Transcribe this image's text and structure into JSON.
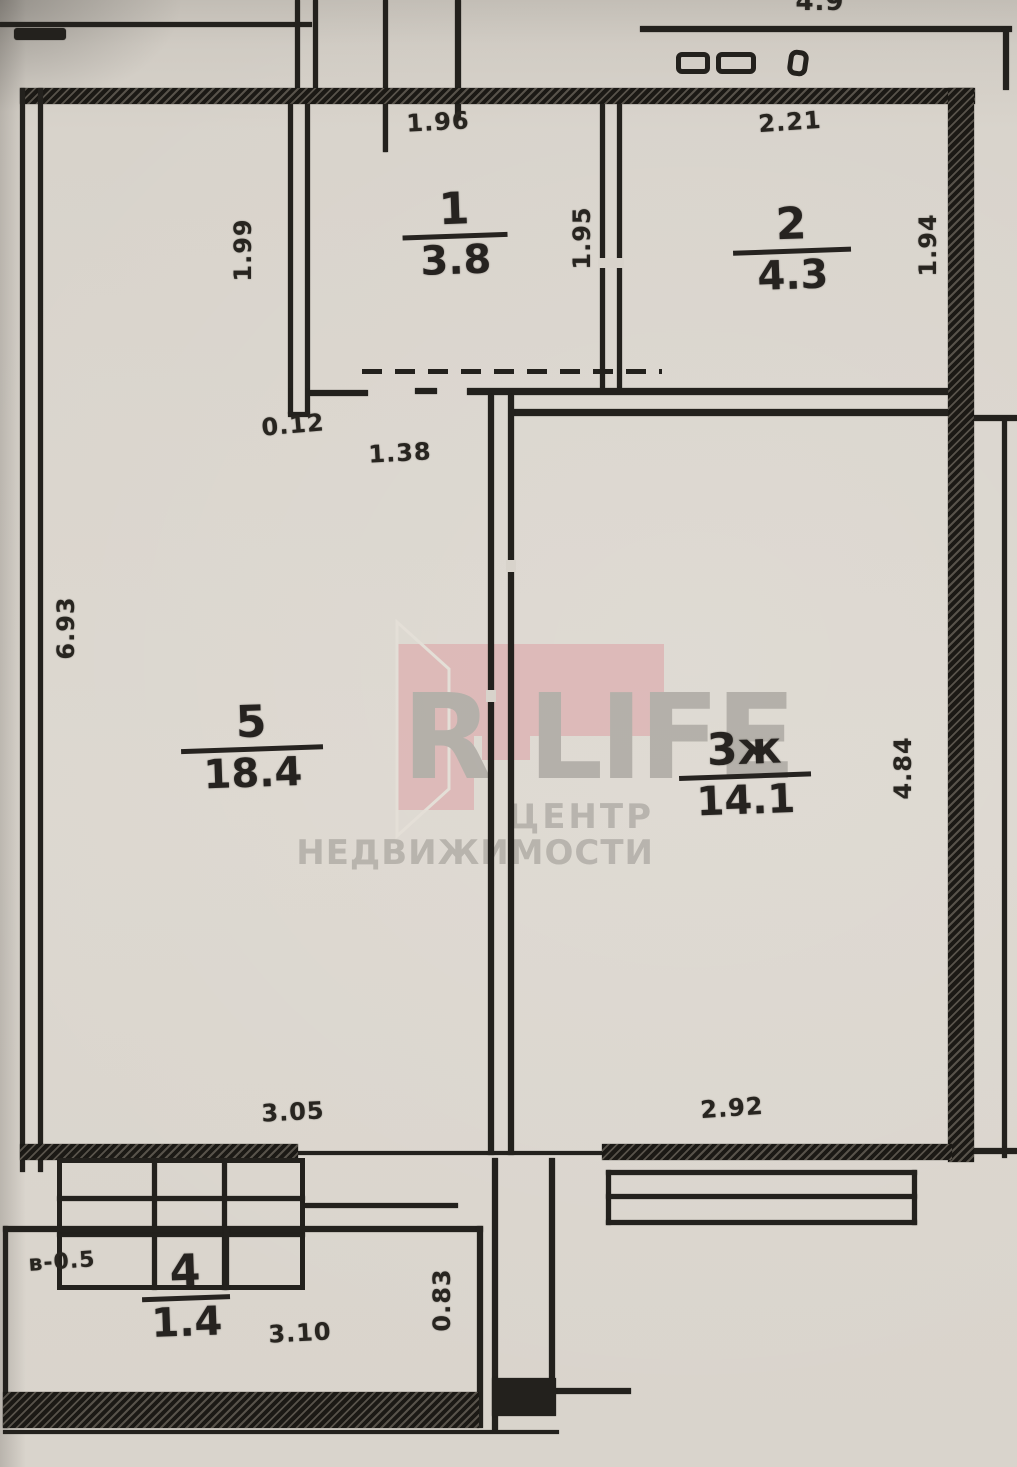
{
  "watermark": {
    "brand_left": "R",
    "brand_right": "LIFE",
    "sub1": "ЦЕНТР",
    "sub2": "НЕДВИЖИМОСТИ",
    "pink": "#dd9ea3",
    "gray": "#8e8b85"
  },
  "rooms": [
    {
      "number": "1",
      "area": "3.8"
    },
    {
      "number": "2",
      "area": "4.3"
    },
    {
      "number": "3ж",
      "area": "14.1"
    },
    {
      "number": "4",
      "area": "1.4"
    },
    {
      "number": "5",
      "area": "18.4"
    }
  ],
  "dimensions": {
    "top_partial": "4.9",
    "room1_width": "1.96",
    "room1_height": "1.95",
    "room2_width": "2.21",
    "room2_height": "1.94",
    "left_strip_height": "1.99",
    "wall_stub": "0.12",
    "opening": "1.38",
    "room5_height": "6.93",
    "room5_width": "3.05",
    "room3_width": "2.92",
    "room3_height": "4.84",
    "balcony_note": "в-0.5",
    "balcony_width": "3.10",
    "balcony_depth": "0.83"
  }
}
